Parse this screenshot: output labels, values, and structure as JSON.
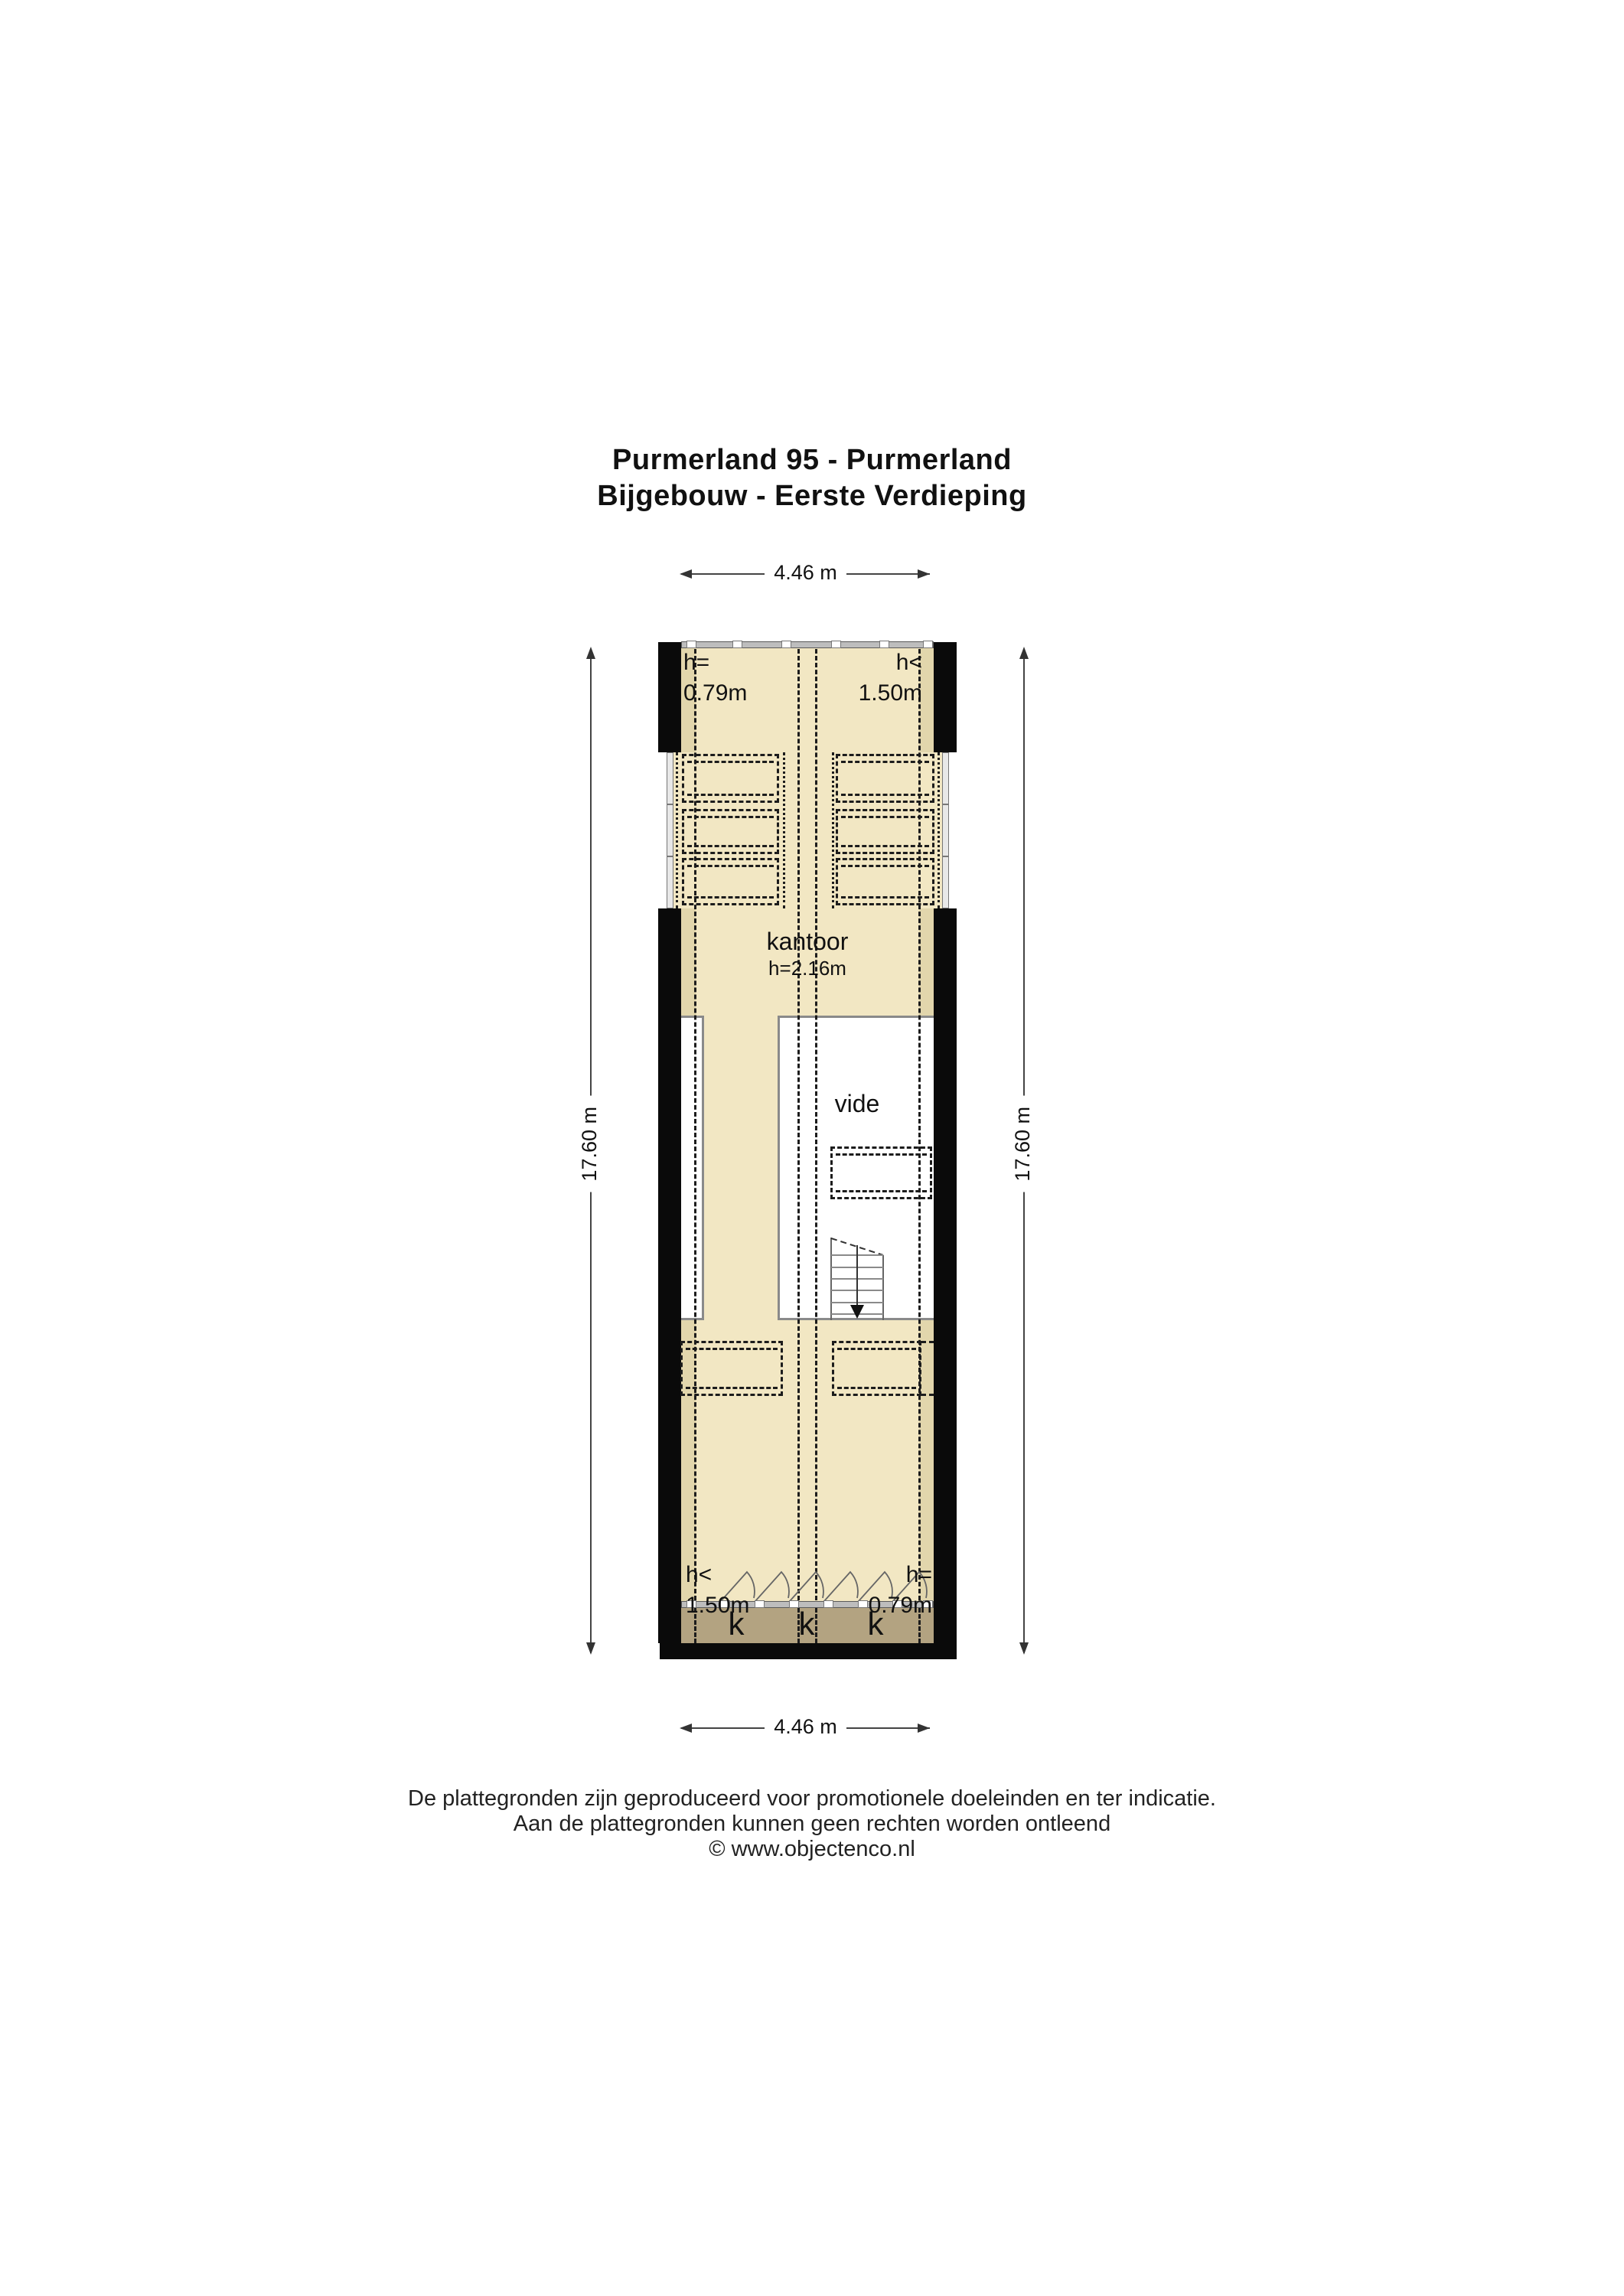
{
  "title": {
    "line1": "Purmerland 95 - Purmerland",
    "line2": "Bijgebouw - Eerste Verdieping"
  },
  "dimensions": {
    "top": "4.46 m",
    "bottom": "4.46 m",
    "left": "17.60 m",
    "right": "17.60 m"
  },
  "height_labels": {
    "top_left": {
      "line1": "h=",
      "line2": "0.79m"
    },
    "top_right": {
      "line1": "h<",
      "line2": "1.50m"
    },
    "bottom_left": {
      "line1": "h<",
      "line2": "1.50m"
    },
    "bottom_right": {
      "line1": "h=",
      "line2": "0.79m"
    }
  },
  "rooms": {
    "kantoor": {
      "name": "kantoor",
      "height": "h=2.16m"
    },
    "vide": {
      "name": "vide"
    }
  },
  "closets": {
    "labels": [
      "k",
      "k",
      "k"
    ]
  },
  "footer": {
    "line1": "De plattegronden zijn geproduceerd voor promotionele doeleinden en ter indicatie.",
    "line2": "Aan de plattegronden kunnen geen rechten worden ontleend",
    "line3": "© www.objectenco.nl"
  },
  "colors": {
    "floor": "#f2e7c3",
    "floor_shade": "#e2d6ac",
    "closet_band": "#b3a381",
    "wall": "#0a0a0a",
    "window_gray": "#bdbdbd",
    "line": "#1c1c1c"
  }
}
